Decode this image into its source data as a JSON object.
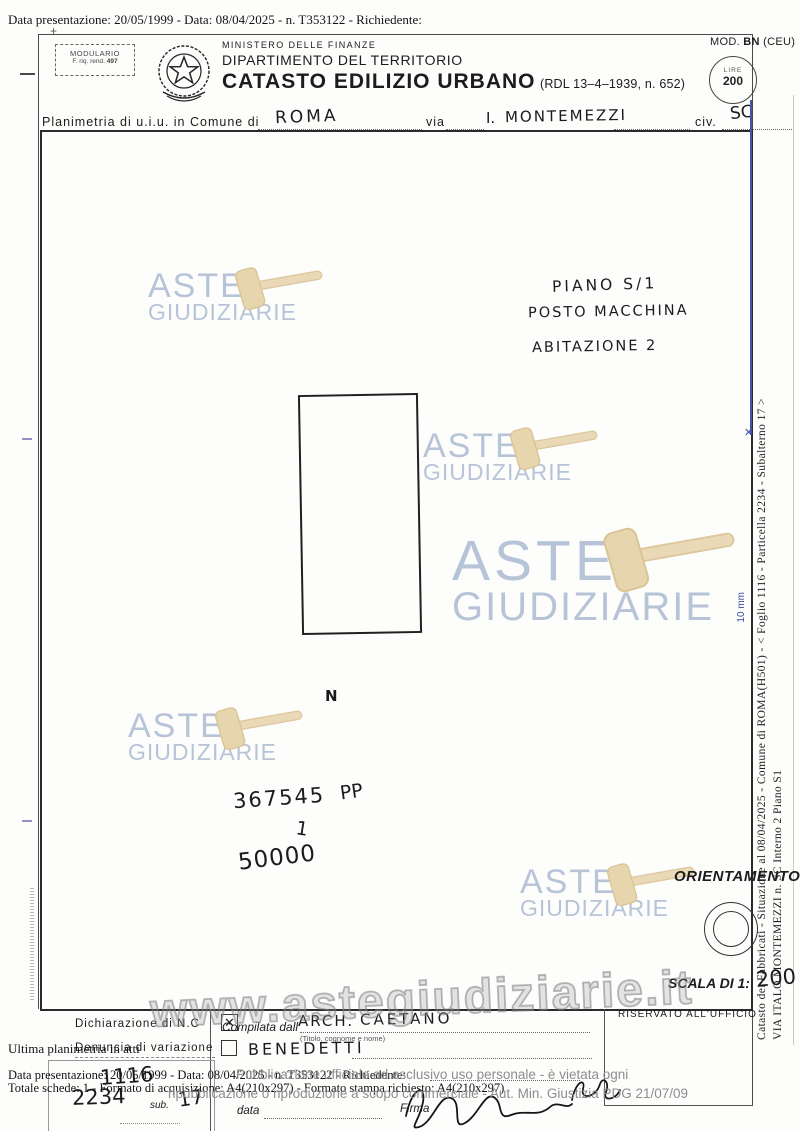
{
  "overlay": {
    "top_line": "Data presentazione: 20/05/1999 - Data: 08/04/2025 - n. T353122 - Richiedente:",
    "ultima": "Ultima planimetria in atti",
    "data_line": "Data presentazione: 20/05/1999 - Data: 08/04/2025 - n. T353122 - Richiedente:",
    "totale_line": "Totale schede: 1 - Formato di acquisizione: A4(210x297) - Formato stampa richiesto: A4(210x297)",
    "pub1": "Pubblicazione ufficiale ad esclusivo uso personale - è vietata ogni",
    "pub2": "ripubblicazione o riproduzione a scopo commerciale - Aut. Min. Giustizia PDG 21/07/09"
  },
  "header": {
    "mod_label": "MOD.",
    "mod_code": "BN",
    "mod_suffix": "(CEU)",
    "modulario_line1": "MODULARIO",
    "modulario_line2": "F. riq. rend.",
    "modulario_num": "497",
    "ministry": "MINISTERO DELLE FINANZE",
    "department": "DIPARTIMENTO DEL TERRITORIO",
    "title": "CATASTO EDILIZIO URBANO",
    "title_ref": "(RDL 13–4–1939, n. 652)",
    "stamp_currency": "LIRE",
    "stamp_value": "200"
  },
  "location_line": {
    "label1": "Planimetria di u.i.u. in Comune di",
    "comune": "ROMA",
    "label_via": "via",
    "via_prefix": "I.",
    "via_name": "MONTEMEZZI",
    "label_civ": "civ.",
    "civ": "SC"
  },
  "drawing": {
    "notes": [
      "PIANO S/1",
      "POSTO MACCHINA",
      "ABITAZIONE 2"
    ],
    "north": "N",
    "figure_code": "367545",
    "figure_pp": "PP",
    "figure_one": "1",
    "figure_price": "50000",
    "orientamento_label": "ORIENTAMENTO",
    "scala_label": "SCALA DI 1:",
    "scala_value": "200",
    "ruler_label": "10 mm",
    "ruler_tick": "✕"
  },
  "footer_form": {
    "dichiarazione_label": "Dichiarazione di N.C",
    "denuncia_label": "Denuncia di variazione",
    "checkbox_mark": "✕",
    "foglio": "1116",
    "particella": "2234",
    "sub_label": "sub.",
    "subalterno": "17",
    "compilata_label": "Compilata dall'",
    "compilata_title": "ARCH.",
    "compilata_name": "CAETANO",
    "compilata_surname": "BENEDETTI",
    "titolo_hint": "(Titolo, cognome e nome)",
    "data_label": "data",
    "firma_label": "Firma",
    "riservato_label": "RISERVATO ALL'UFFICIO"
  },
  "side_text": {
    "line1": "Catasto dei Fabbricati - Situazione al 08/04/2025 - Comune di ROMA(H501) - < Foglio 1116 - Particella 2234 - Subalterno 17 >",
    "line2": "VIA ITALO MONTEMEZZI n. SC Interno 2 Piano S1"
  },
  "watermark": {
    "aste": "ASTE",
    "giudiziarie": "GIUDIZIARIE",
    "url": "www.astegiudiziarie.it"
  },
  "colors": {
    "watermark_text": "#b7c4d8",
    "gavel": "#ead9b6",
    "ruler_blue": "#4353a8",
    "overlay_gray": "#8d8d8d"
  }
}
